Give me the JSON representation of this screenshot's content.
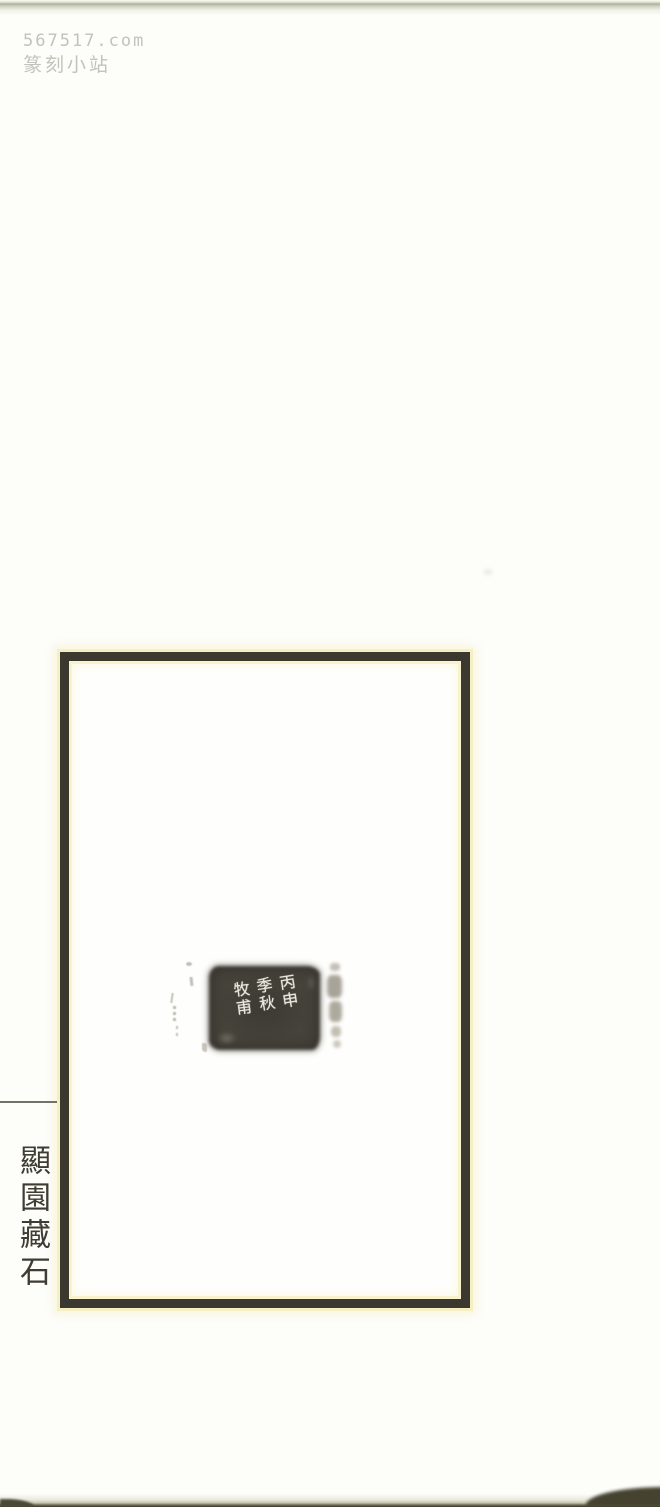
{
  "watermark": {
    "site": "567517.com",
    "name": "篆刻小站"
  },
  "seal_impression": {
    "columns": [
      {
        "position": "right",
        "text": "丙申"
      },
      {
        "position": "middle",
        "text": "季秋"
      },
      {
        "position": "left",
        "text": "牧甫"
      }
    ]
  },
  "side_caption": {
    "text": "顯園藏石"
  },
  "colors": {
    "page_background": "#fdfdfa",
    "frame_border": "#3a382f",
    "frame_halo_yellow": "#f6efc3",
    "seal_ink": "#46433b",
    "seal_text": "#ece8de",
    "caption_ink": "#3e3c33",
    "watermark_gray": "#c2c3bb",
    "scan_edge_dark": "#403e2d"
  }
}
